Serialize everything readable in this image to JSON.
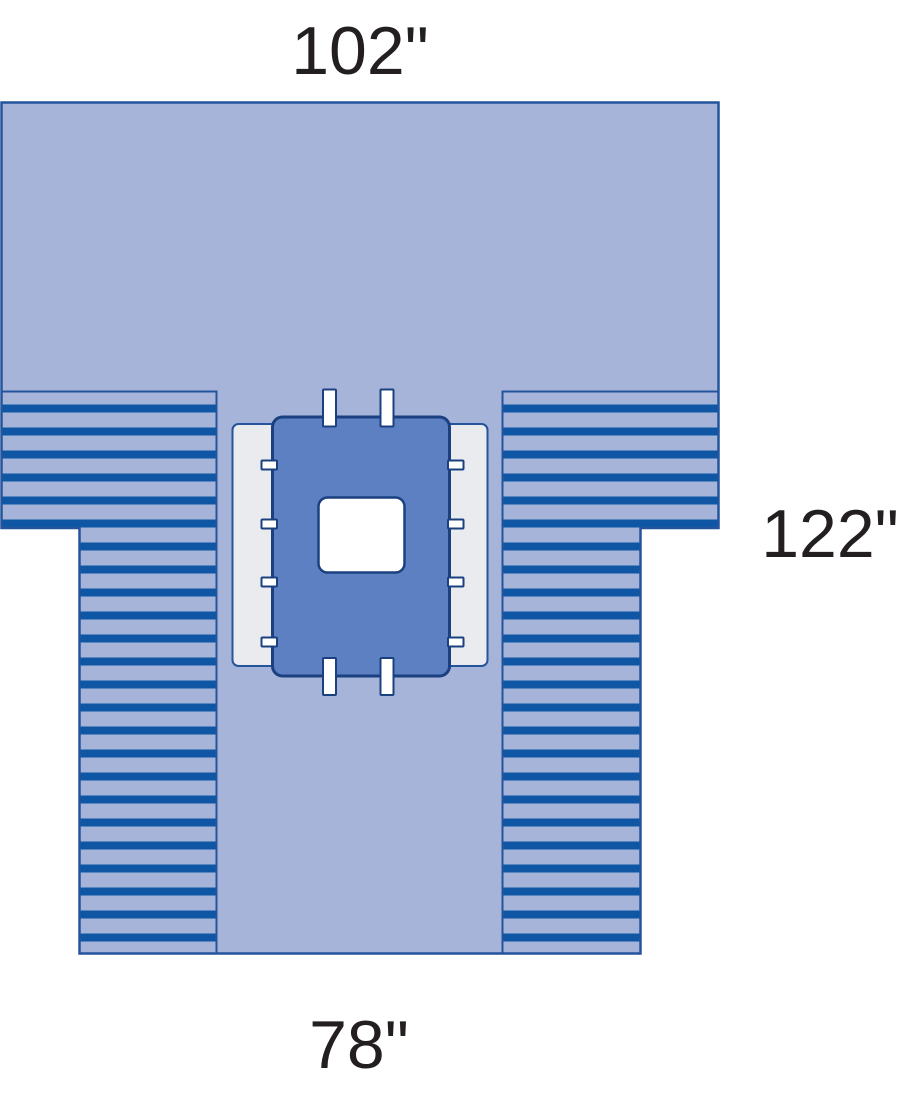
{
  "diagram": {
    "kind": "surgical-drape-dimensional-diagram",
    "labels": {
      "width_top": "102\"",
      "length_right": "122\"",
      "width_bottom": "78\""
    }
  },
  "colors": {
    "background": "#ffffff",
    "drape": "#a6b4da",
    "pleat_stripe": "#0f57a5",
    "outline": "#24549c",
    "panel": "#e9ebef",
    "center_panel": "#5c80c2",
    "dark_outline": "#1b4080",
    "fenestration": "#ffffff",
    "label_text": "#231f20"
  }
}
